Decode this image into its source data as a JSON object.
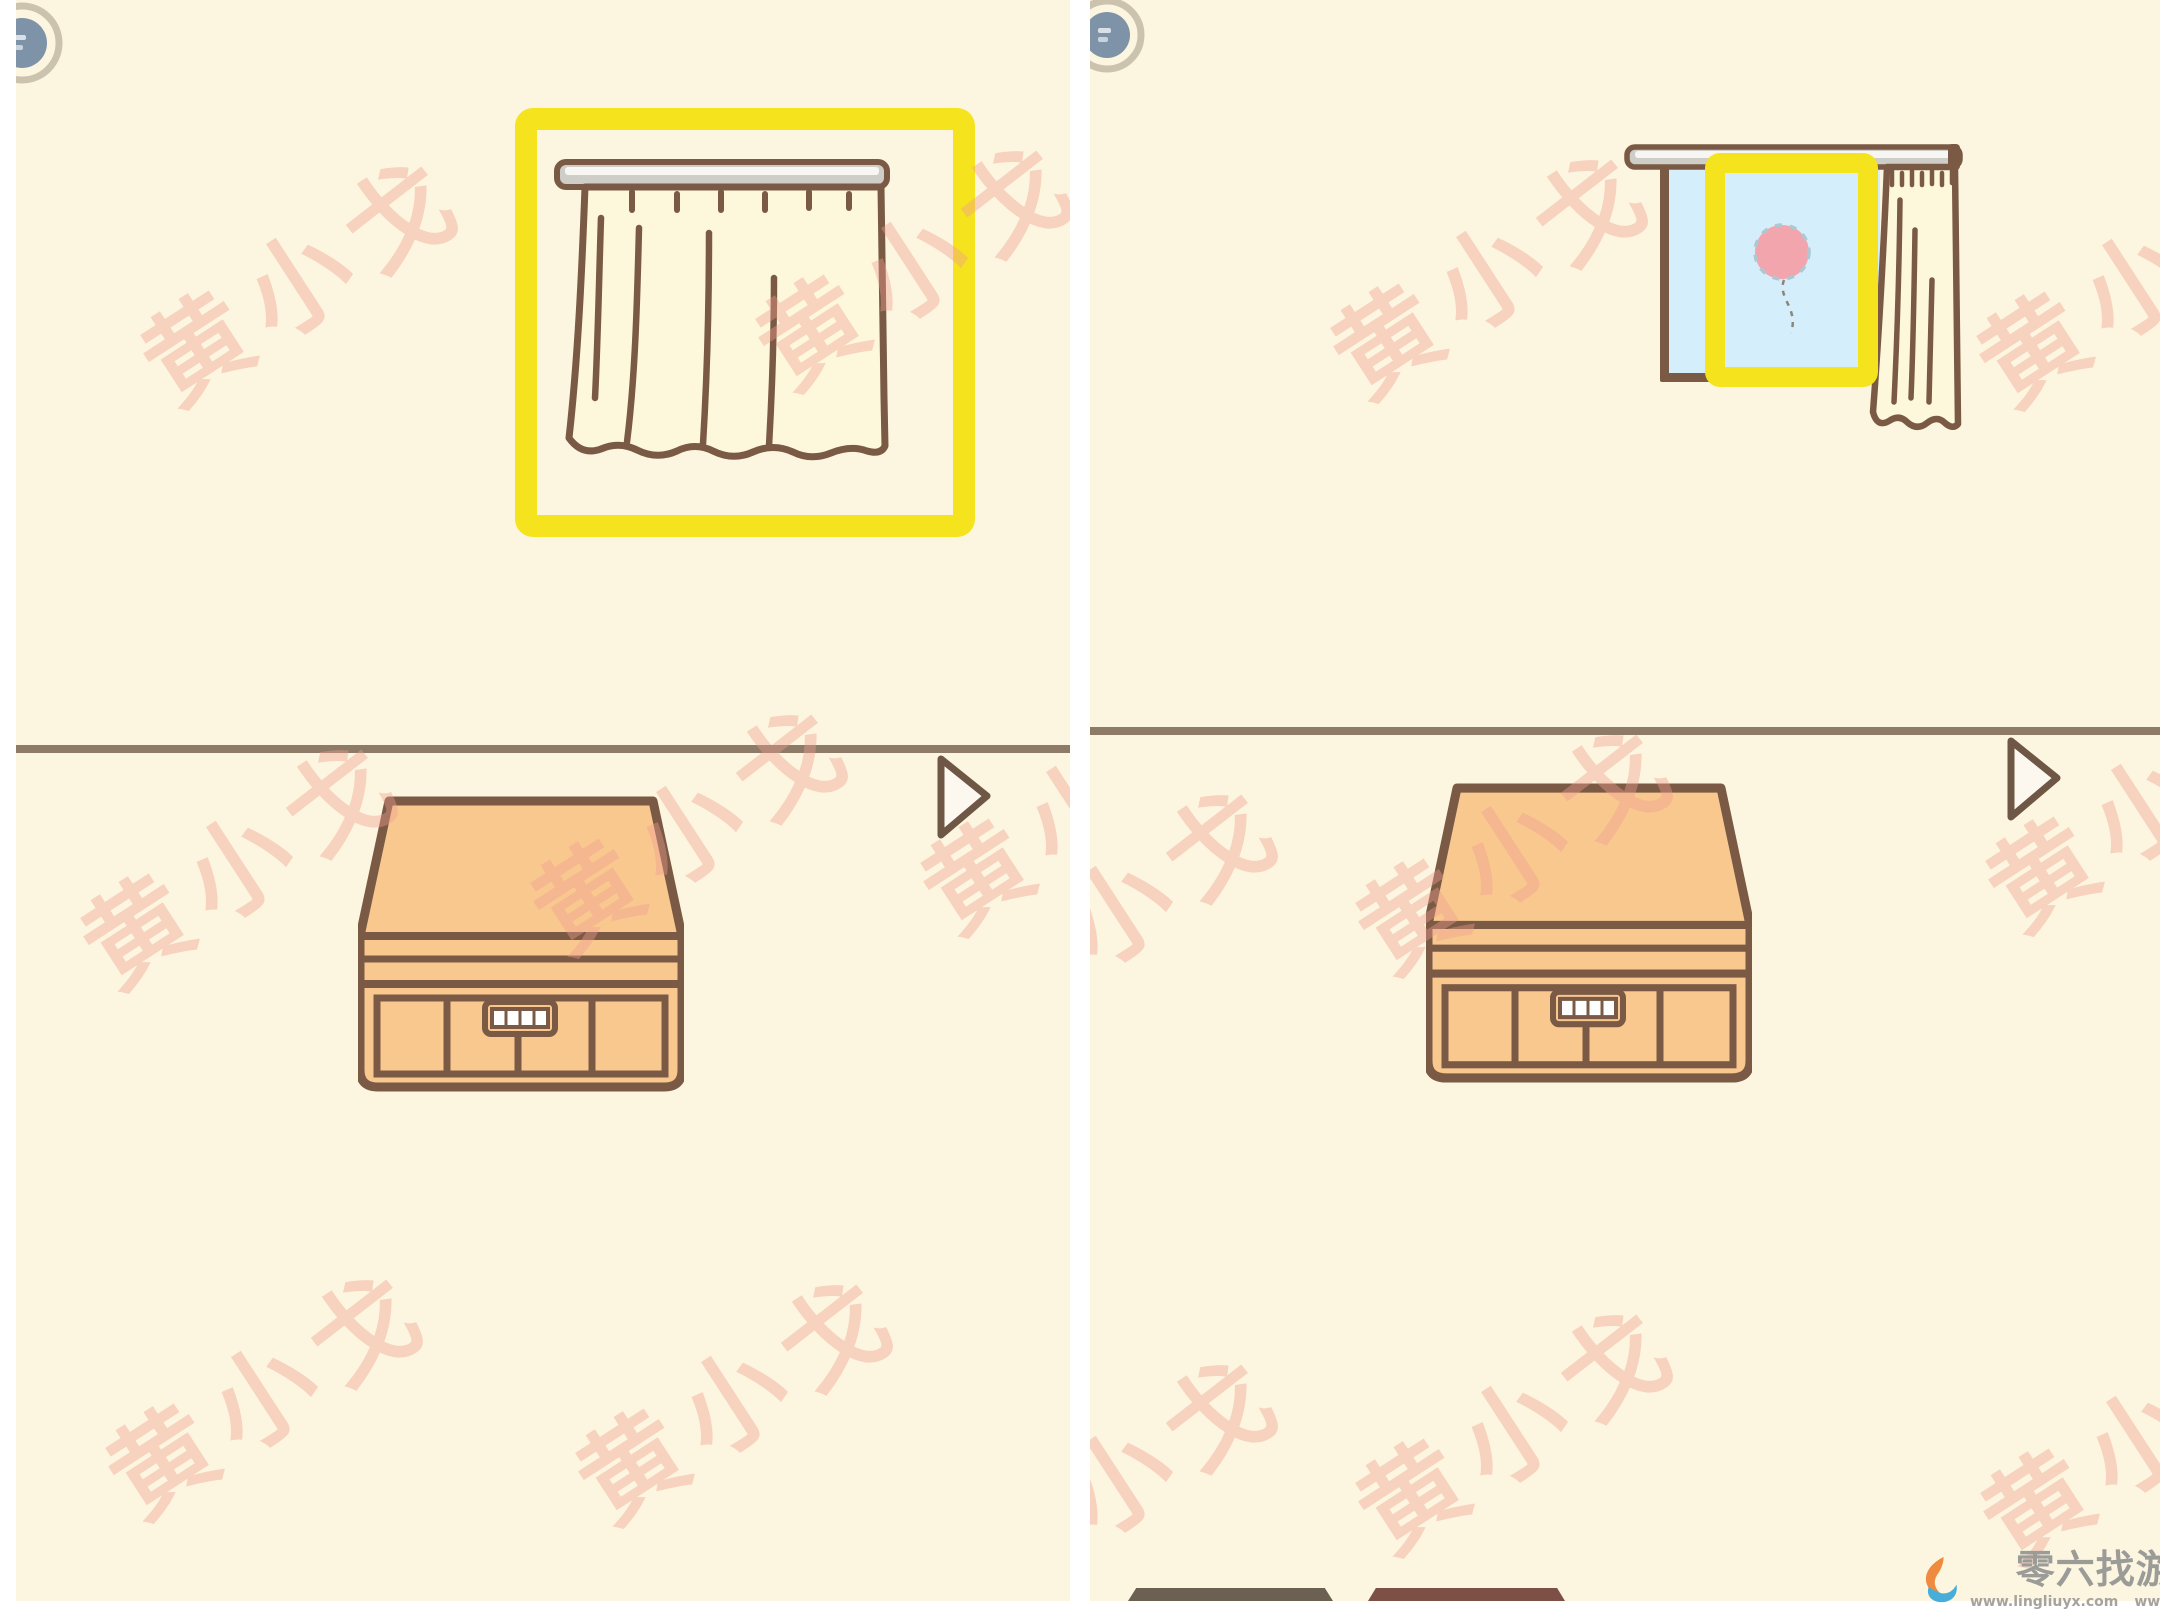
{
  "app": {
    "description_label": "two-step walkthrough screenshot of a hand-drawn hidden-object puzzle game"
  },
  "watermark": {
    "text": "黄小戈",
    "color": "#f19e90",
    "instances": [
      {
        "panel": 0,
        "x": 284,
        "y": 272
      },
      {
        "panel": 0,
        "x": 899,
        "y": 256
      },
      {
        "panel": 0,
        "x": 224,
        "y": 855
      },
      {
        "panel": 0,
        "x": 674,
        "y": 820
      },
      {
        "panel": 0,
        "x": 1064,
        "y": 800
      },
      {
        "panel": 0,
        "x": 249,
        "y": 1385
      },
      {
        "panel": 0,
        "x": 719,
        "y": 1390
      },
      {
        "panel": 1,
        "x": 400,
        "y": 265
      },
      {
        "panel": 1,
        "x": 1046,
        "y": 273
      },
      {
        "panel": 1,
        "x": 425,
        "y": 840
      },
      {
        "panel": 1,
        "x": 1055,
        "y": 798
      },
      {
        "panel": 1,
        "x": 30,
        "y": 900
      },
      {
        "panel": 1,
        "x": 425,
        "y": 1420
      },
      {
        "panel": 1,
        "x": 1050,
        "y": 1430
      },
      {
        "panel": 1,
        "x": 30,
        "y": 1470
      }
    ]
  },
  "panels": [
    {
      "name": "step-1",
      "state_label": "curtain closed, curtain highlighted"
    },
    {
      "name": "step-2",
      "state_label": "curtain pulled open, balloon in window highlighted"
    }
  ],
  "credit": {
    "brand": "零六找游戏",
    "url_left": "www.lingliuyx.com",
    "url_right": "www.06zyx.com"
  },
  "colors": {
    "panel_background": "#fcf6e0",
    "highlight_yellow": "#f5e31d",
    "outline_brown": "#7a5a44",
    "curtain_cream": "#fdf7dc",
    "window_blue": "#d4effb",
    "balloon_pink": "#f3a5ad",
    "cabinet_peach": "#f9c88f",
    "divider_brown": "#8d7b67",
    "watermark_pink": "#f19e90",
    "corner_icon_blue": "#7e93a8",
    "corner_ring_tan": "#ccc3af",
    "logo_orange": "#f08a3e",
    "logo_blue": "#46aed8"
  }
}
